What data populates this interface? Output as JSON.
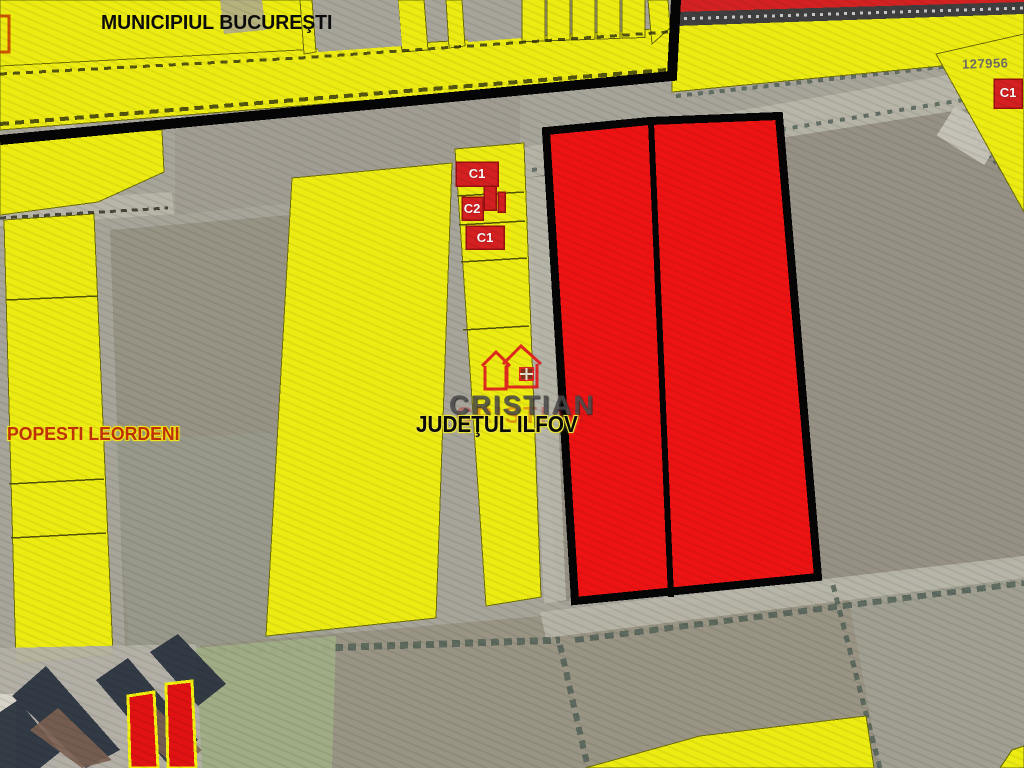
{
  "map": {
    "regions": {
      "top": "MUNICIPIUL BUCUREŞTI",
      "left": "POPESTI LEORDENI",
      "center": "JUDEŢUL ILFOV"
    },
    "parcel_number": "127956",
    "buildings": {
      "c1_top": "C1",
      "c2_mid": "C2",
      "c1_lower": "C1",
      "c1_right": "C1"
    },
    "logo": {
      "brand": "CRISTIAN",
      "watermark": "CRISTIAN",
      "icon": "house-logo-icon"
    },
    "colors": {
      "zone_yellow": "#EDED12",
      "parcel_red": "#EE1313",
      "boundary_black": "#050505",
      "railway_red": "#D42222",
      "label_red": "#C13208",
      "field_brown": "#8D8677",
      "field_green": "#A0AD85"
    }
  }
}
